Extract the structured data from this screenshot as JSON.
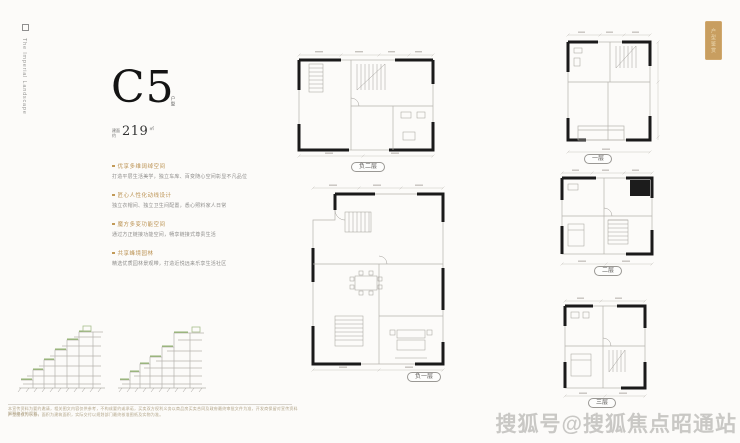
{
  "page": {
    "brand_text": "The Imperial Landscape",
    "corner_tag": "户型鉴赏",
    "watermark": "搜狐号@搜狐焦点昭通站",
    "disclaimer_line1": "本宣传资料为要约邀请，相关图文内容仅供参考，不构成要约或承诺，买卖双方权利义务以商品房买卖合同及政府最终审批文件为准，开发商保留对宣传资料解释修改的权利。",
    "disclaimer_line2": "户型图仅为示意，面积为建筑面积，实际交付以规划部门最终核准图纸及实物为准。"
  },
  "unit": {
    "name": "C5",
    "name_suffix": "户型",
    "area_prefix_top": "建面",
    "area_prefix_bottom": "约",
    "area_value": "219",
    "area_unit": "㎡"
  },
  "features": [
    {
      "title": "优享多维阔绰空间",
      "desc": "打造平层生活美学，独立车库、百变随心空间彰显不凡品位"
    },
    {
      "title": "匠心人性化动线设计",
      "desc": "独立衣帽间、独立卫生间配置，悉心照料家人日常"
    },
    {
      "title": "魔方多变功能空间",
      "desc": "通过方正链接功能空间，畅享链接式尊贵生活"
    },
    {
      "title": "共享峰境园林",
      "desc": "精选优质园林景观带，打造近悦远来乐享生活社区"
    }
  ],
  "plans": {
    "basement2": "负二层",
    "basement1": "负一层",
    "floor1": "一层",
    "floor2": "二层",
    "floor3": "三层"
  }
}
